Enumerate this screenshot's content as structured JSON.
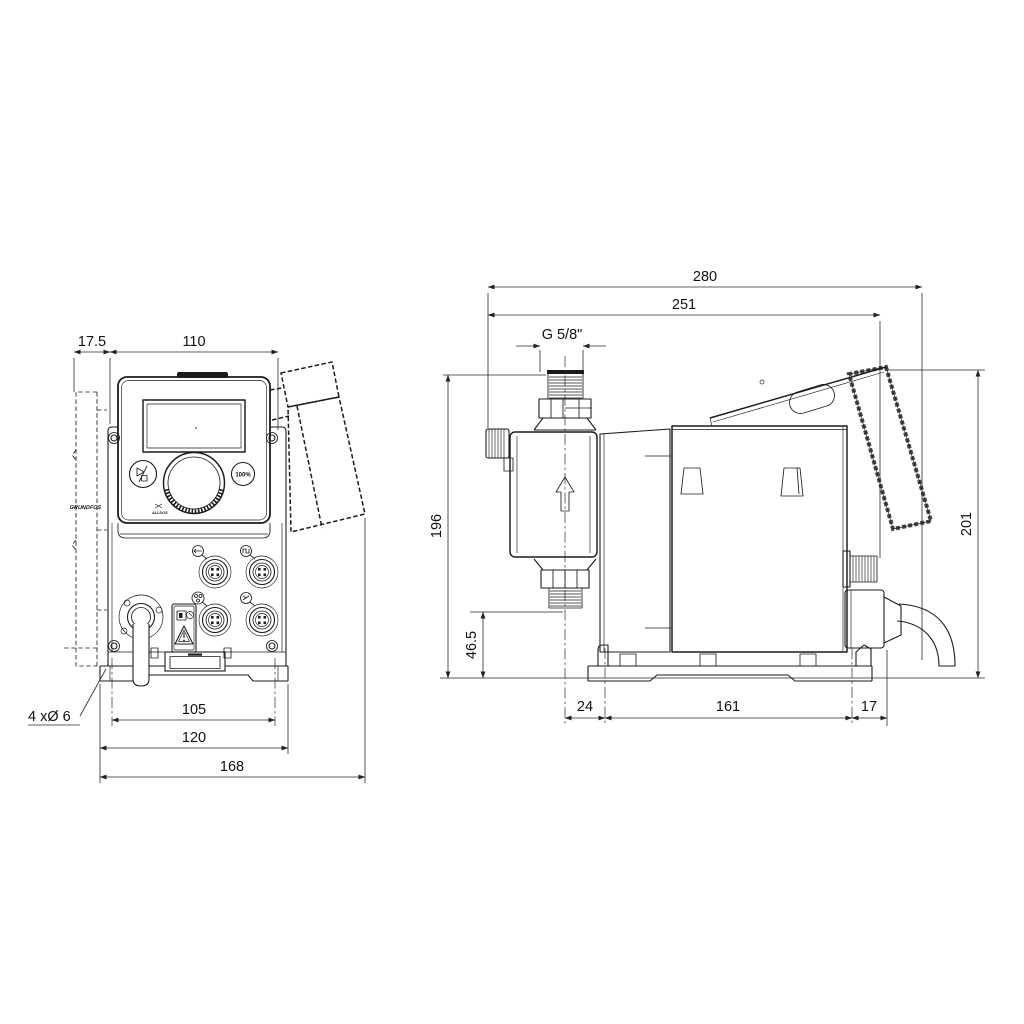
{
  "drawing": {
    "brand": "GRUNDFOS",
    "brand_sub": "ALLDOS",
    "front_view": {
      "dim_offset": "17.5",
      "dim_width": "110",
      "dim_hole_callout": "4 xØ 6",
      "dim_hole_spacing": "105",
      "dim_plate_width": "120",
      "dim_overall_width": "168",
      "btn_max": "100%"
    },
    "side_view": {
      "dim_overall_depth": "280",
      "dim_depth": "251",
      "dim_thread": "G 5/8\"",
      "dim_height": "196",
      "dim_valve_height": "46.5",
      "dim_front": "24",
      "dim_hole_spacing": "161",
      "dim_rear": "17",
      "dim_height_panel": "201"
    }
  }
}
